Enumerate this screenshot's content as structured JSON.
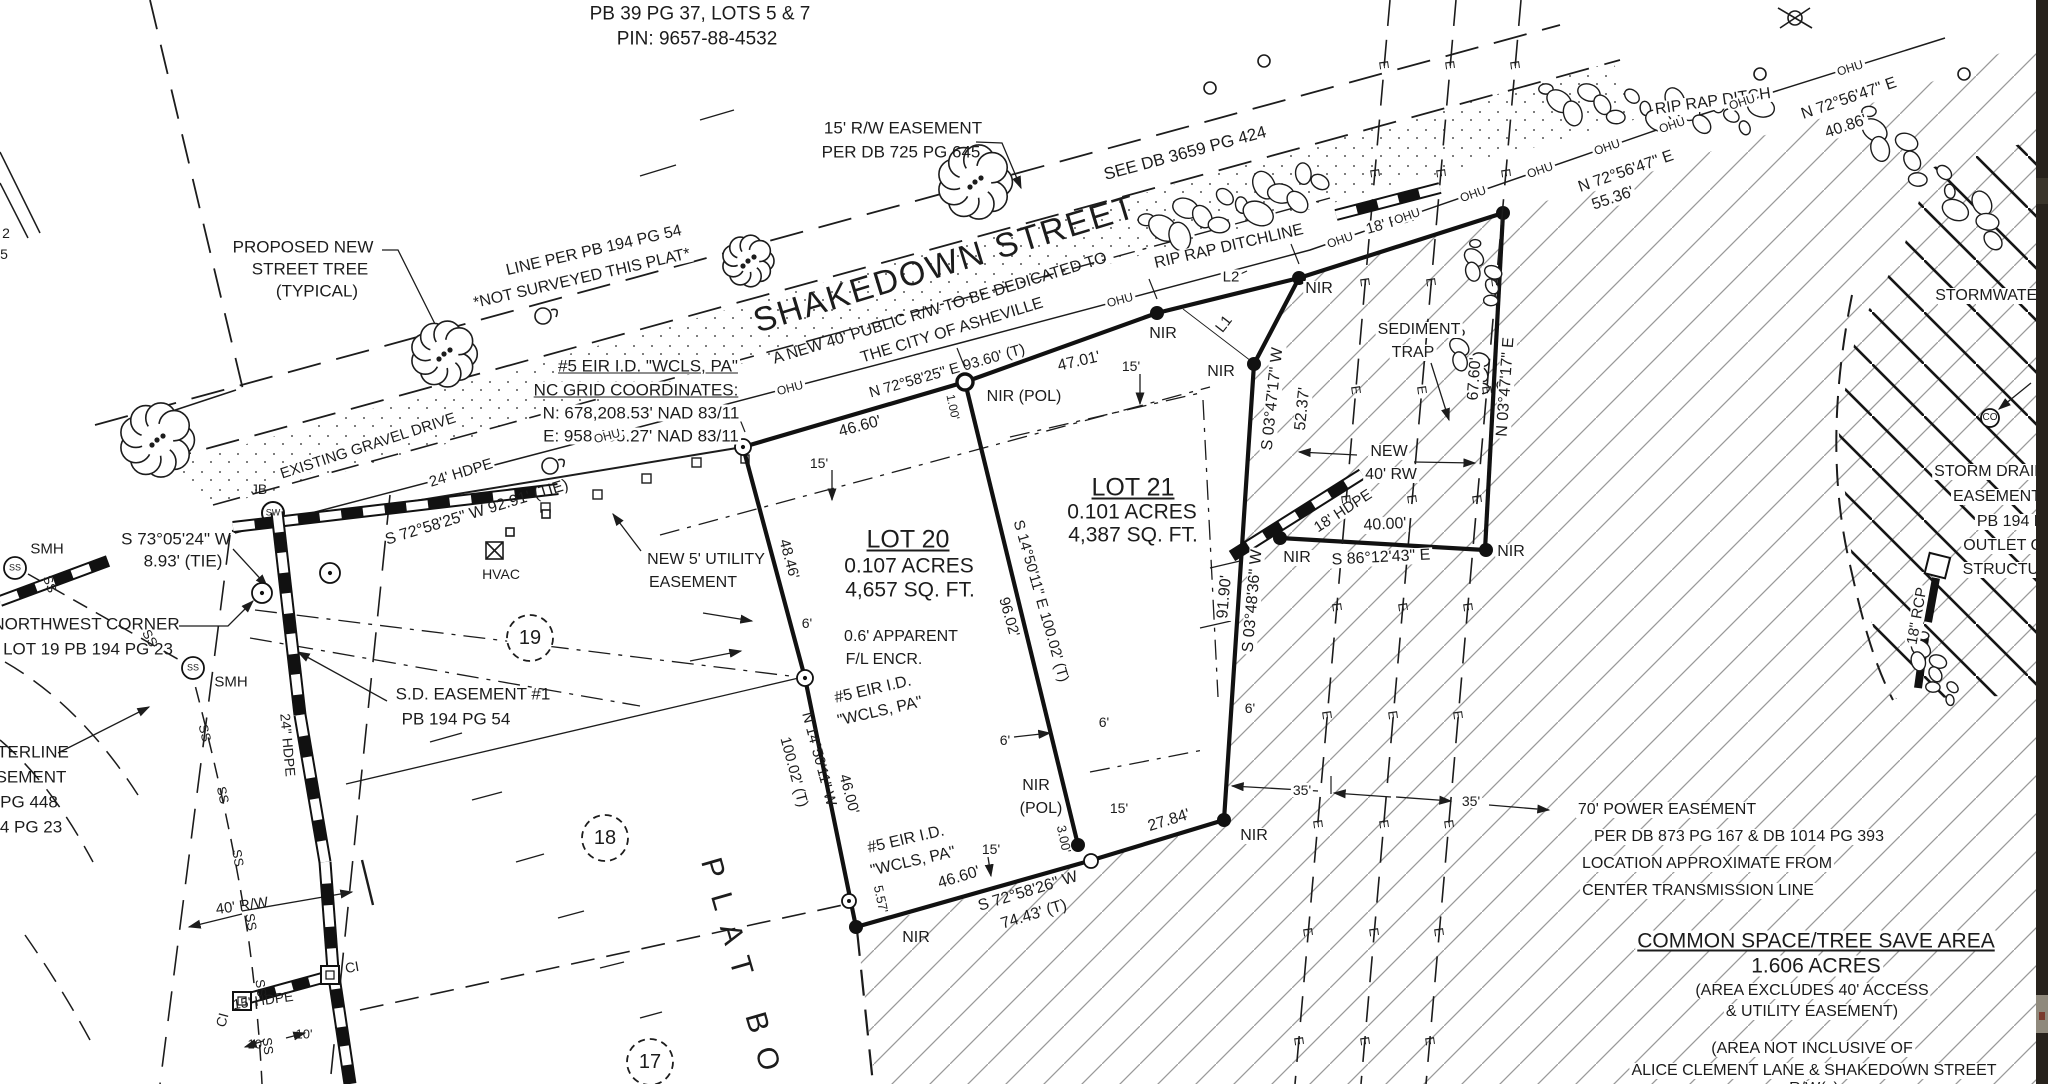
{
  "document_type": "survey-plat",
  "colors": {
    "ink": "#1c1c1c",
    "hatch_light": "#9a9a9a",
    "hatch_heavy": "#161616",
    "paper": "#ffffff",
    "edge_strip": "#27221c"
  },
  "power_lines": {
    "mark": "E",
    "mark_spacing": 105,
    "lines": [
      [
        1390,
        0,
        1295,
        1084
      ],
      [
        1456,
        0,
        1361,
        1084
      ],
      [
        1521,
        0,
        1426,
        1084
      ]
    ]
  },
  "utility_line": {
    "mark": "OHU",
    "points": [
      [
        235,
        533
      ],
      [
        960,
        343
      ],
      [
        1310,
        250
      ],
      [
        1700,
        115
      ],
      [
        1945,
        38
      ]
    ],
    "mark_xs": [
      607,
      790,
      1120,
      1340,
      1407,
      1473,
      1540,
      1607,
      1672,
      1742,
      1850
    ]
  },
  "trees": [
    [
      157,
      440,
      36
    ],
    [
      444,
      354,
      32
    ],
    [
      748,
      261,
      25
    ],
    [
      975,
      182,
      36
    ]
  ],
  "riprap": [
    {
      "from": [
        1150,
        232
      ],
      "to": [
        1320,
        182
      ],
      "n": 14,
      "s": 15
    },
    {
      "from": [
        1545,
        100
      ],
      "to": [
        1760,
        118
      ],
      "n": 16,
      "s": 13
    },
    {
      "from": [
        1862,
        120
      ],
      "to": [
        2000,
        232
      ],
      "n": 12,
      "s": 13
    },
    {
      "from": [
        1468,
        248
      ],
      "to": [
        1498,
        296
      ],
      "n": 6,
      "s": 10
    },
    {
      "from": [
        1452,
        338
      ],
      "to": [
        1496,
        392
      ],
      "n": 7,
      "s": 10
    },
    {
      "from": [
        1916,
        640
      ],
      "to": [
        1950,
        700
      ],
      "n": 8,
      "s": 10
    }
  ],
  "lot_circles": [
    {
      "n": "19",
      "x": 530,
      "y": 638
    },
    {
      "n": "18",
      "x": 605,
      "y": 838
    },
    {
      "n": "17",
      "x": 650,
      "y": 1062
    }
  ],
  "labels": [
    {
      "t": "PB 39 PG 37, LOTS 5 & 7",
      "x": 700,
      "y": 14,
      "s": 19
    },
    {
      "t": "PIN: 9657-88-4532",
      "x": 697,
      "y": 39,
      "s": 19
    },
    {
      "t": "15' R/W EASEMENT",
      "x": 903,
      "y": 128,
      "s": 17
    },
    {
      "t": "PER DB 725 PG 645",
      "x": 901,
      "y": 152,
      "s": 17
    },
    {
      "t": "SEE DB 3659 PG 424",
      "x": 1185,
      "y": 153,
      "r": -15,
      "s": 17,
      "bg": true
    },
    {
      "t": "SHAKEDOWN STREET",
      "x": 945,
      "y": 264,
      "r": -17,
      "s": 34,
      "ls": 2
    },
    {
      "t": "A NEW 40' PUBLIC R/W TO BE DEDICATED TO",
      "x": 940,
      "y": 309,
      "r": -17,
      "s": 16
    },
    {
      "t": "THE CITY OF ASHEVILLE",
      "x": 952,
      "y": 331,
      "r": -17,
      "s": 16
    },
    {
      "t": "PROPOSED NEW",
      "x": 303,
      "y": 247,
      "s": 17
    },
    {
      "t": "STREET TREE",
      "x": 310,
      "y": 269,
      "s": 17
    },
    {
      "t": "(TYPICAL)",
      "x": 317,
      "y": 291,
      "s": 17
    },
    {
      "t": "LINE PER PB 194 PG 54",
      "x": 594,
      "y": 251,
      "r": -13,
      "s": 16,
      "bg": true
    },
    {
      "t": "*NOT SURVEYED THIS PLAT*",
      "x": 582,
      "y": 279,
      "r": -13,
      "s": 16,
      "bg": true
    },
    {
      "t": "#5 EIR I.D. \"WCLS, PA\"",
      "x": 648,
      "y": 366,
      "s": 17,
      "u": true,
      "bg": true
    },
    {
      "t": "NC GRID COORDINATES:",
      "x": 636,
      "y": 390,
      "s": 17,
      "u": true,
      "bg": true
    },
    {
      "t": "N: 678,208.53' NAD 83/11",
      "x": 641,
      "y": 413,
      "s": 17,
      "bg": true
    },
    {
      "t": "E: 958,485.27' NAD 83/11",
      "x": 641,
      "y": 436,
      "s": 17,
      "bg": true
    },
    {
      "t": "EXISTING GRAVEL DRIVE",
      "x": 368,
      "y": 446,
      "r": -18,
      "s": 15,
      "bg": true
    },
    {
      "t": "24' HDPE",
      "x": 461,
      "y": 473,
      "r": -17,
      "s": 15,
      "bg": true
    },
    {
      "t": "S 72°58'25\" W  92.91' (TIE)",
      "x": 477,
      "y": 513,
      "r": -17,
      "s": 16
    },
    {
      "t": "S 73°05'24\" W",
      "x": 176,
      "y": 539,
      "s": 17
    },
    {
      "t": "8.93' (TIE)",
      "x": 183,
      "y": 561,
      "s": 17
    },
    {
      "t": "JB",
      "x": 259,
      "y": 489,
      "s": 14
    },
    {
      "t": "NORTHWEST CORNER",
      "x": 86,
      "y": 624,
      "s": 17
    },
    {
      "t": "LOT 19 PB 194 PG 23",
      "x": 88,
      "y": 649,
      "s": 17
    },
    {
      "t": "SMH",
      "x": 47,
      "y": 549,
      "s": 15
    },
    {
      "t": "SMH",
      "x": 231,
      "y": 682,
      "s": 15
    },
    {
      "t": "S.D. EASEMENT #1",
      "x": 473,
      "y": 694,
      "s": 17
    },
    {
      "t": "PB 194 PG 54",
      "x": 456,
      "y": 719,
      "s": 17
    },
    {
      "t": "HVAC",
      "x": 501,
      "y": 574,
      "s": 14
    },
    {
      "t": "NEW 5' UTILITY",
      "x": 706,
      "y": 560,
      "s": 16
    },
    {
      "t": "EASEMENT",
      "x": 693,
      "y": 583,
      "s": 16
    },
    {
      "t": "N 72°58'25\" E  93.60' (T)",
      "x": 947,
      "y": 371,
      "r": -16,
      "s": 15
    },
    {
      "t": "46.60'",
      "x": 860,
      "y": 427,
      "r": -15,
      "s": 16
    },
    {
      "t": "15'",
      "x": 819,
      "y": 463,
      "s": 14
    },
    {
      "t": "47.01'",
      "x": 1079,
      "y": 362,
      "r": -13,
      "s": 16
    },
    {
      "t": "15'",
      "x": 1131,
      "y": 366,
      "s": 14
    },
    {
      "t": "NIR (POL)",
      "x": 1024,
      "y": 397,
      "s": 16,
      "bg": true
    },
    {
      "t": "1.00'",
      "x": 953,
      "y": 407,
      "r": 78,
      "s": 12
    },
    {
      "t": "NIR",
      "x": 1163,
      "y": 334,
      "s": 16,
      "bg": true
    },
    {
      "t": "L2",
      "x": 1231,
      "y": 277,
      "s": 15,
      "bg": true
    },
    {
      "t": "L1",
      "x": 1224,
      "y": 324,
      "r": -52,
      "s": 15
    },
    {
      "t": "NIR",
      "x": 1319,
      "y": 289,
      "s": 16,
      "bg": true
    },
    {
      "t": "RIP RAP DITCHLINE",
      "x": 1229,
      "y": 247,
      "r": -13,
      "s": 16,
      "bg": true
    },
    {
      "t": "RIP RAP DITCH",
      "x": 1713,
      "y": 102,
      "r": -8,
      "s": 16,
      "bg": true
    },
    {
      "t": "N 72°56'47\" E",
      "x": 1849,
      "y": 99,
      "r": -19,
      "s": 16,
      "bg": true
    },
    {
      "t": "40.86'",
      "x": 1846,
      "y": 127,
      "r": -19,
      "s": 16,
      "bg": true
    },
    {
      "t": "N 72°56'47\" E",
      "x": 1626,
      "y": 172,
      "r": -19,
      "s": 16,
      "bg": true
    },
    {
      "t": "55.36'",
      "x": 1613,
      "y": 199,
      "r": -19,
      "s": 16,
      "bg": true
    },
    {
      "t": "STORMWATER",
      "x": 1992,
      "y": 296,
      "s": 16,
      "bg": true
    },
    {
      "t": "SEDIMENT",
      "x": 1419,
      "y": 330,
      "s": 16,
      "bg": true
    },
    {
      "t": "TRAP",
      "x": 1413,
      "y": 353,
      "s": 16,
      "bg": true
    },
    {
      "t": "S 03°47'17\" W",
      "x": 1273,
      "y": 399,
      "r": -84,
      "s": 16,
      "bg": true
    },
    {
      "t": "52.37'",
      "x": 1303,
      "y": 409,
      "r": -84,
      "s": 16,
      "bg": true
    },
    {
      "t": "67.60'",
      "x": 1475,
      "y": 379,
      "r": -86,
      "s": 16,
      "bg": true
    },
    {
      "t": "N 03°47'17\" E",
      "x": 1506,
      "y": 387,
      "r": -86,
      "s": 16,
      "bg": true
    },
    {
      "t": "NEW",
      "x": 1389,
      "y": 452,
      "s": 16,
      "bg": true
    },
    {
      "t": "40' RW",
      "x": 1391,
      "y": 475,
      "s": 16,
      "bg": true
    },
    {
      "t": "18' HDPE",
      "x": 1343,
      "y": 511,
      "r": -33,
      "s": 15,
      "bg": true
    },
    {
      "t": "40.00'",
      "x": 1385,
      "y": 525,
      "r": -3,
      "s": 16,
      "bg": true
    },
    {
      "t": "S 86°12'43\" E",
      "x": 1381,
      "y": 558,
      "r": -3,
      "s": 16,
      "bg": true
    },
    {
      "t": "NIR",
      "x": 1297,
      "y": 558,
      "s": 16,
      "bg": true
    },
    {
      "t": "NIR",
      "x": 1511,
      "y": 552,
      "s": 16,
      "bg": true
    },
    {
      "t": "NIR",
      "x": 1221,
      "y": 372,
      "s": 16,
      "bg": true
    },
    {
      "t": "LOT 21",
      "x": 1133,
      "y": 488,
      "s": 25,
      "u": true
    },
    {
      "t": "0.101 ACRES",
      "x": 1132,
      "y": 512,
      "s": 21
    },
    {
      "t": "4,387 SQ. FT.",
      "x": 1133,
      "y": 535,
      "s": 21
    },
    {
      "t": "LOT 20",
      "x": 908,
      "y": 540,
      "s": 25,
      "u": true
    },
    {
      "t": "0.107 ACRES",
      "x": 909,
      "y": 566,
      "s": 21
    },
    {
      "t": "4,657 SQ. FT.",
      "x": 910,
      "y": 590,
      "s": 21
    },
    {
      "t": "S 14°50'11\" E  100.02' (T)",
      "x": 1041,
      "y": 601,
      "r": 74,
      "s": 15
    },
    {
      "t": "96.02'",
      "x": 1009,
      "y": 617,
      "r": 74,
      "s": 15
    },
    {
      "t": "N 14°50'11\" W",
      "x": 819,
      "y": 759,
      "r": 75,
      "s": 15
    },
    {
      "t": "100.02' (T)",
      "x": 794,
      "y": 772,
      "r": 75,
      "s": 15
    },
    {
      "t": "46.00'",
      "x": 849,
      "y": 794,
      "r": 75,
      "s": 15
    },
    {
      "t": "48.46'",
      "x": 789,
      "y": 559,
      "r": 75,
      "s": 15
    },
    {
      "t": "6'",
      "x": 807,
      "y": 623,
      "s": 14
    },
    {
      "t": "0.6' APPARENT",
      "x": 901,
      "y": 637,
      "s": 16
    },
    {
      "t": "F/L ENCR.",
      "x": 884,
      "y": 660,
      "s": 16
    },
    {
      "t": "#5 EIR I.D.",
      "x": 873,
      "y": 690,
      "r": -13,
      "s": 16
    },
    {
      "t": "\"WCLS, PA\"",
      "x": 880,
      "y": 712,
      "r": -13,
      "s": 16
    },
    {
      "t": "#5 EIR I.D.",
      "x": 906,
      "y": 840,
      "r": -13,
      "s": 16
    },
    {
      "t": "\"WCLS, PA\"",
      "x": 913,
      "y": 862,
      "r": -13,
      "s": 16
    },
    {
      "t": "5.57'",
      "x": 881,
      "y": 899,
      "r": 78,
      "s": 13
    },
    {
      "t": "NIR",
      "x": 916,
      "y": 938,
      "s": 16
    },
    {
      "t": "46.60'",
      "x": 959,
      "y": 878,
      "r": -17,
      "s": 16
    },
    {
      "t": "S 72°58'26\" W",
      "x": 1028,
      "y": 892,
      "r": -17,
      "s": 16
    },
    {
      "t": "74.43' (T)",
      "x": 1034,
      "y": 915,
      "r": -17,
      "s": 16
    },
    {
      "t": "15'",
      "x": 991,
      "y": 849,
      "s": 14
    },
    {
      "t": "NIR",
      "x": 1036,
      "y": 786,
      "s": 16
    },
    {
      "t": "(POL)",
      "x": 1041,
      "y": 809,
      "s": 16
    },
    {
      "t": "3.00'",
      "x": 1064,
      "y": 839,
      "r": 78,
      "s": 13
    },
    {
      "t": "15'",
      "x": 1119,
      "y": 808,
      "s": 14
    },
    {
      "t": "27.84'",
      "x": 1169,
      "y": 821,
      "r": -17,
      "s": 16,
      "bg": true
    },
    {
      "t": "NIR",
      "x": 1254,
      "y": 836,
      "s": 16,
      "bg": true
    },
    {
      "t": "6'",
      "x": 1005,
      "y": 740,
      "s": 14
    },
    {
      "t": "6'",
      "x": 1104,
      "y": 722,
      "s": 14
    },
    {
      "t": "6'",
      "x": 1250,
      "y": 708,
      "s": 14,
      "bg": true
    },
    {
      "t": "35'",
      "x": 1302,
      "y": 790,
      "s": 14,
      "bg": true
    },
    {
      "t": "35'",
      "x": 1471,
      "y": 801,
      "s": 14,
      "bg": true
    },
    {
      "t": "91.90'",
      "x": 1225,
      "y": 597,
      "r": -85,
      "s": 16,
      "bg": true
    },
    {
      "t": "S 03°48'36\" W",
      "x": 1253,
      "y": 601,
      "r": -85,
      "s": 16,
      "bg": true
    },
    {
      "t": "70' POWER EASEMENT",
      "x": 1667,
      "y": 810,
      "s": 16,
      "bg": true
    },
    {
      "t": "PER DB 873 PG 167 & DB 1014 PG 393",
      "x": 1739,
      "y": 837,
      "s": 16,
      "bg": true
    },
    {
      "t": "LOCATION APPROXIMATE FROM",
      "x": 1707,
      "y": 864,
      "s": 16,
      "bg": true
    },
    {
      "t": "CENTER TRANSMISSION LINE",
      "x": 1698,
      "y": 891,
      "s": 16,
      "bg": true
    },
    {
      "t": "COMMON SPACE/TREE SAVE AREA",
      "x": 1816,
      "y": 941,
      "s": 21,
      "u": true,
      "bg": true
    },
    {
      "t": "1.606 ACRES",
      "x": 1816,
      "y": 966,
      "s": 21,
      "bg": true
    },
    {
      "t": "(AREA EXCLUDES 40' ACCESS",
      "x": 1812,
      "y": 991,
      "s": 16,
      "bg": true
    },
    {
      "t": "& UTILITY EASEMENT)",
      "x": 1812,
      "y": 1012,
      "s": 16,
      "bg": true
    },
    {
      "t": "(AREA NOT INCLUSIVE OF",
      "x": 1812,
      "y": 1049,
      "s": 16,
      "bg": true
    },
    {
      "t": "ALICE CLEMENT LANE & SHAKEDOWN STREET",
      "x": 1814,
      "y": 1071,
      "s": 16,
      "bg": true
    },
    {
      "t": "R/W(s)",
      "x": 1814,
      "y": 1089,
      "s": 16,
      "bg": true
    },
    {
      "t": "STORM DRAIN",
      "x": 1990,
      "y": 472,
      "s": 16,
      "bg": true
    },
    {
      "t": "EASEMENT",
      "x": 1997,
      "y": 497,
      "s": 16,
      "bg": true
    },
    {
      "t": "PB 194 PG 54",
      "x": 2028,
      "y": 522,
      "s": 16,
      "bg": true
    },
    {
      "t": "OUTLET CONTROL",
      "x": 2036,
      "y": 546,
      "s": 16,
      "bg": true
    },
    {
      "t": "STRUCTURE",
      "x": 2012,
      "y": 570,
      "s": 16,
      "bg": true
    },
    {
      "t": "18\" RCP",
      "x": 1917,
      "y": 616,
      "r": -80,
      "s": 15,
      "bg": true
    },
    {
      "t": "18' RCP",
      "x": 1393,
      "y": 222,
      "r": -16,
      "s": 15,
      "bg": true
    },
    {
      "t": "CO",
      "x": 1990,
      "y": 418,
      "s": 10
    },
    {
      "t": "SW",
      "x": 273,
      "y": 513,
      "s": 9
    },
    {
      "t": "SS",
      "x": 15,
      "y": 568,
      "s": 9
    },
    {
      "t": "SS",
      "x": 193,
      "y": 668,
      "s": 9
    },
    {
      "t": "CI",
      "x": 352,
      "y": 967,
      "r": -10,
      "s": 14
    },
    {
      "t": "CI",
      "x": 222,
      "y": 1020,
      "r": -75,
      "s": 14
    },
    {
      "t": "40' R/W",
      "x": 242,
      "y": 906,
      "r": -8,
      "s": 15
    },
    {
      "t": "15' HDPE",
      "x": 263,
      "y": 1000,
      "r": -8,
      "s": 14
    },
    {
      "t": "10'",
      "x": 256,
      "y": 1044,
      "s": 13
    },
    {
      "t": "10'",
      "x": 304,
      "y": 1034,
      "s": 13
    },
    {
      "t": "24\" HDPE",
      "x": 288,
      "y": 745,
      "r": 85,
      "s": 14
    },
    {
      "t": "2",
      "x": 6,
      "y": 233,
      "s": 14
    },
    {
      "t": "5",
      "x": 4,
      "y": 254,
      "s": 14
    },
    {
      "t": "TERLINE",
      "x": 33,
      "y": 752,
      "s": 17
    },
    {
      "t": "SEMENT",
      "x": 31,
      "y": 777,
      "s": 17
    },
    {
      "t": "PG 448",
      "x": 29,
      "y": 802,
      "s": 17
    },
    {
      "t": "4 PG 23",
      "x": 31,
      "y": 827,
      "s": 17
    },
    {
      "t": "PLAT BO",
      "x": 742,
      "y": 972,
      "r": 74,
      "s": 30,
      "ls": 16
    },
    {
      "t": "SS",
      "x": 50,
      "y": 584,
      "r": 70,
      "s": 13
    },
    {
      "t": "SS",
      "x": 150,
      "y": 638,
      "r": 60,
      "s": 13
    },
    {
      "t": "SS",
      "x": 205,
      "y": 733,
      "r": 76,
      "s": 13
    },
    {
      "t": "SS",
      "x": 223,
      "y": 795,
      "r": 78,
      "s": 13
    },
    {
      "t": "SS",
      "x": 238,
      "y": 858,
      "r": 80,
      "s": 13
    },
    {
      "t": "SS",
      "x": 251,
      "y": 922,
      "r": 80,
      "s": 13
    },
    {
      "t": "SS",
      "x": 261,
      "y": 988,
      "r": 82,
      "s": 13
    },
    {
      "t": "SS",
      "x": 268,
      "y": 1046,
      "r": 83,
      "s": 13
    }
  ]
}
